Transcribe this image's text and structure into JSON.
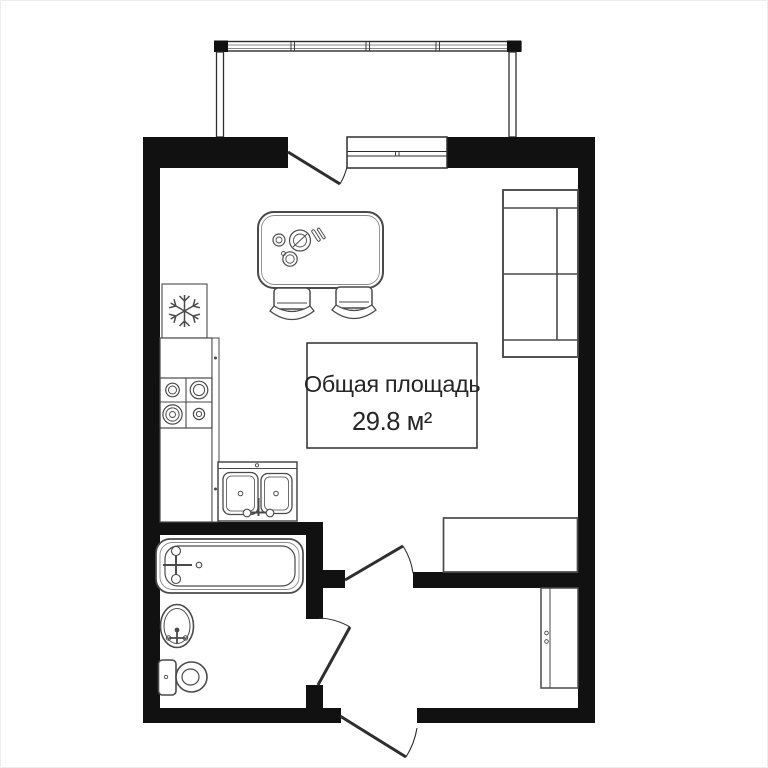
{
  "plan": {
    "area_label": {
      "line1": "Общая площадь",
      "line2": "29.8 м²"
    }
  },
  "colors": {
    "wall": "#111111",
    "outline": "#2e2e2e",
    "furniture": "#4a4a4a",
    "furniture_light": "#8a8a8a",
    "text": "#262626",
    "background": "#ffffff"
  },
  "symbols": {
    "snowflake": "snowflake-icon (refrigerator)",
    "burners": "stove-burners-icon",
    "double_basin": "kitchen-sink-icon",
    "table": "dining-table-icon",
    "chairs": "chair-icon",
    "sofa": "sofa-icon",
    "bathtub": "bathtub-icon",
    "washbasin": "washbasin-icon",
    "toilet": "toilet-icon",
    "wardrobe": "wardrobe-icon",
    "dresser": "dresser-icon",
    "window": "window-symbol",
    "doors": "door-swing-symbol",
    "balcony": "balcony-railing-symbol"
  }
}
